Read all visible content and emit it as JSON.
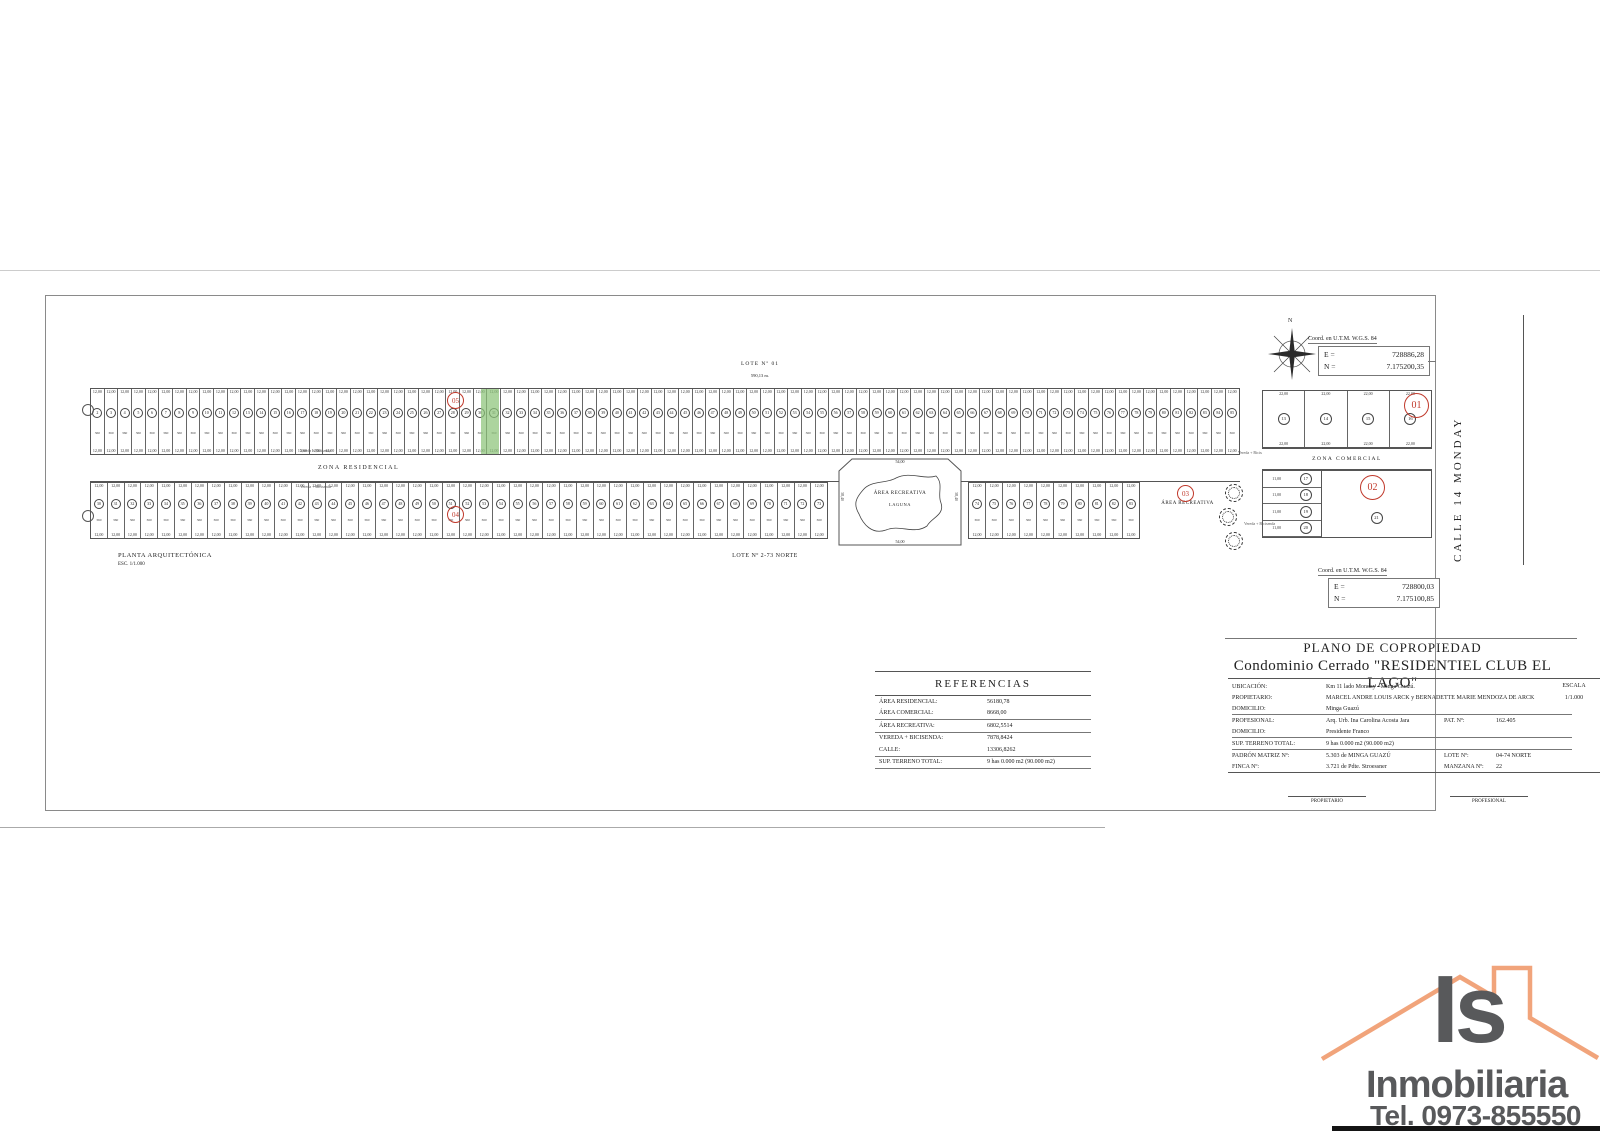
{
  "plan": {
    "top_lot_label": "LOTE Nº 01",
    "top_dimension": "590,13 m.",
    "residential_street_label": "ZONA RESIDENCIAL",
    "sidewalk_label": "Vereda + Bicisenda",
    "bottom_caption": "LOTE Nº 2-73 NORTE",
    "plan_title": "PLANTA ARQUITECTÓNICA",
    "plan_scale": "ESC. 1/1.000",
    "recreation_area_label": "ÁREA RECREATIVA",
    "lagoon_label": "LAGUNA",
    "recreation_area_2_label": "ÁREA RECREATIVA",
    "commercial_street_label": "ZONA COMERCIAL",
    "street_right_label": "CALLE 14 MONDAY",
    "compass_label": "N",
    "lot_width_label": "12,00",
    "lot_area_label": "360",
    "recreation_dim_h": "54,00",
    "recreation_dim_v": "38,40",
    "markers": {
      "m01": "01",
      "m02": "02",
      "m03": "03",
      "m04": "04",
      "m05": "05"
    },
    "coord_box_top": {
      "title": "Coord. en U.T.M. W.G.S. 84",
      "e": "E =",
      "e_val": "728886,28",
      "n": "N =",
      "n_val": "7.175200,35"
    },
    "coord_box_bottom": {
      "title": "Coord. en U.T.M. W.G.S. 84",
      "e": "E =",
      "e_val": "728800,03",
      "n": "N =",
      "n_val": "7.175100,85"
    },
    "lot_rows": [
      {
        "x": 90,
        "y": 388,
        "w": 1150,
        "h": 67,
        "count": 84,
        "start": 2
      },
      {
        "x": 90,
        "y": 482,
        "w": 738,
        "h": 57,
        "count": 44,
        "start": 30
      },
      {
        "x": 968,
        "y": 482,
        "w": 172,
        "h": 57,
        "count": 10,
        "start": 74
      }
    ],
    "commercial": {
      "lot_dim": "22,00",
      "side_dim": "11,00",
      "top_lots": [
        "13",
        "14",
        "15",
        "16"
      ],
      "side_lots": [
        "17",
        "18",
        "19",
        "20"
      ],
      "big_lot": "21"
    }
  },
  "referencias": {
    "title": "REFERENCIAS",
    "rows": [
      {
        "label": "ÁREA RESIDENCIAL:",
        "value": "56180,78",
        "rule": false
      },
      {
        "label": "ÁREA COMERCIAL:",
        "value": "8668,00",
        "rule": true
      },
      {
        "label": "ÁREA RECREATIVA:",
        "value": "6802,5514",
        "rule": true
      },
      {
        "label": "VEREDA + BICISENDA:",
        "value": "7878,8424",
        "rule": false
      },
      {
        "label": "CALLE:",
        "value": "13306,8262",
        "rule": true
      },
      {
        "label": "SUP. TERRENO TOTAL:",
        "value": "9 has 0.000 m2 (90.000 m2)",
        "rule": true
      }
    ]
  },
  "title_block": {
    "title": "PLANO DE COPROPIEDAD",
    "subtitle": "Condominio Cerrado \"RESIDENTIEL CLUB EL LAGO\"",
    "escala_label": "ESCALA",
    "escala_value": "1/1.000",
    "rows": [
      {
        "label": "UBICACIÓN:",
        "value": "Km 11 lado Monday - Minga Guazú.",
        "rule": false
      },
      {
        "label": "PROPIETARIO:",
        "value": "MARCEL ANDRE LOUIS ARCK y BERNADETTE MARIE MENDOZA DE ARCK",
        "rule": false
      },
      {
        "label": "DOMICILIO:",
        "value": "Minga Guazú",
        "rule": true
      },
      {
        "label": "PROFESIONAL:",
        "value": "Arq. Urb. Ina Carolina Acosta Jara",
        "label2": "PAT. Nº:",
        "value2": "162.405",
        "rule": false
      },
      {
        "label": "DOMICILIO:",
        "value": "Presidente Franco",
        "rule": true
      },
      {
        "label": "SUP. TERRENO TOTAL:",
        "value": "9 has 0.000 m2 (90.000 m2)",
        "rule": true
      },
      {
        "label": "PADRÓN MATRIZ Nº:",
        "value": "5.303 de MINGA GUAZÚ",
        "label2": "LOTE Nº:",
        "value2": "04-74  NORTE",
        "rule": false
      },
      {
        "label": "FINCA Nº:",
        "value": "3.721 de Pdte. Stroessner",
        "label2": "MANZANA Nº:",
        "value2": "22",
        "rule": true
      }
    ],
    "signatures": {
      "left": "PROPIETARIO",
      "right": "PROFESIONAL"
    }
  },
  "logo": {
    "monogram": "Is",
    "name": "Inmobiliaria",
    "phone": "Tel. 0973-855550",
    "roof_color": "#f1a47b",
    "text_color": "#58595b"
  }
}
